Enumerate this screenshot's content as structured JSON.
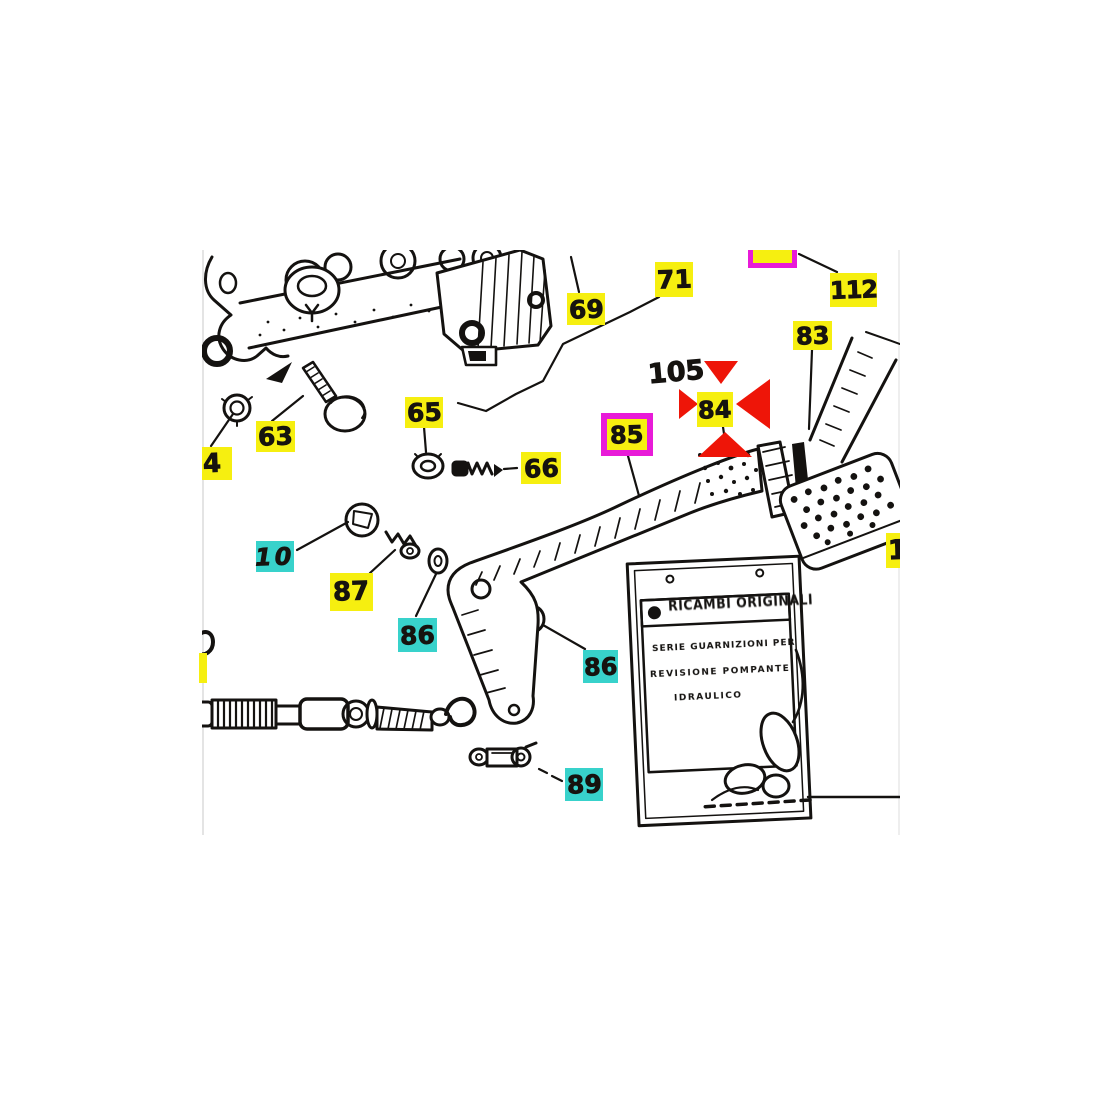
{
  "document": {
    "kind": "exploded-parts-diagram",
    "subject": "pedal and master cylinder assembly"
  },
  "labels": [
    {
      "id": "4",
      "text": "4",
      "color": "yellow"
    },
    {
      "id": "63",
      "text": "63",
      "color": "yellow"
    },
    {
      "id": "65",
      "text": "65",
      "color": "yellow"
    },
    {
      "id": "66",
      "text": "66",
      "color": "yellow"
    },
    {
      "id": "69",
      "text": "69",
      "color": "yellow"
    },
    {
      "id": "71",
      "text": "71",
      "color": "yellow"
    },
    {
      "id": "112",
      "text": "112",
      "color": "yellow"
    },
    {
      "id": "83",
      "text": "83",
      "color": "yellow"
    },
    {
      "id": "84",
      "text": "84",
      "color": "yellow",
      "highlighted": true
    },
    {
      "id": "85",
      "text": "85",
      "color": "yellow",
      "border": "magenta"
    },
    {
      "id": "86a",
      "text": "86",
      "color": "cyan"
    },
    {
      "id": "86b",
      "text": "86",
      "color": "cyan"
    },
    {
      "id": "87",
      "text": "87",
      "color": "yellow"
    },
    {
      "id": "10",
      "text": "10",
      "color": "cyan"
    },
    {
      "id": "89",
      "text": "89",
      "color": "cyan"
    },
    {
      "id": "105",
      "text": "105",
      "color": "none"
    },
    {
      "id": "partial-1",
      "text": "1",
      "color": "yellow"
    }
  ],
  "highlight": {
    "selected_part": "84",
    "marker": "four red arrows"
  },
  "tag_card": {
    "header": "RICAMBI ORIGINALI",
    "line1": "SERIE GUARNIZIONI PER",
    "line2": "REVISIONE POMPANTE",
    "line3": "IDRAULICO"
  },
  "colors": {
    "callout_yellow": "#f6ef10",
    "callout_cyan": "#38d2cb",
    "selection_magenta": "#e81bd8",
    "arrow_red": "#ee1508",
    "line_art": "#141210",
    "background": "#ffffff"
  }
}
